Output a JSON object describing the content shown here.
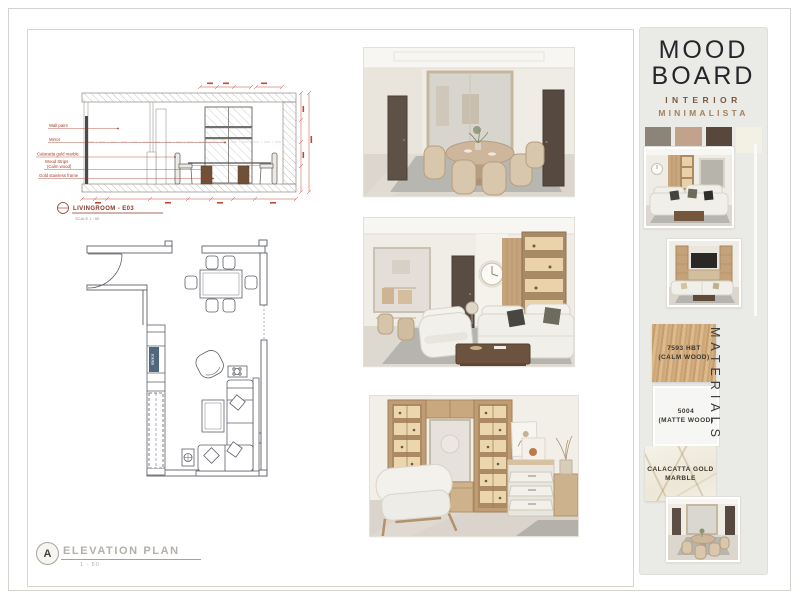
{
  "sheet": {
    "elevation": {
      "callouts": [
        "Wall paint",
        "Mirror",
        "Calacatta gold marble",
        "Wood Strips",
        "(Calm wood)",
        "Gold stainless frame"
      ],
      "title": "LIVINGROOM - E03",
      "scale": "SCALE 1 : 50"
    },
    "floor_plan": {
      "mirror_tag": "mirror"
    },
    "title_block": {
      "marker": "A",
      "label": "ELEVATION PLAN",
      "scale": "1 : 50"
    }
  },
  "moodboard": {
    "title_line_1": "MOOD",
    "title_line_2": "BOARD",
    "subtitle_line_1": "INTERIOR",
    "subtitle_line_2": "MINIMALISTA",
    "palette": [
      {
        "name": "warm-grey",
        "hex": "#8C8478"
      },
      {
        "name": "tan",
        "hex": "#C2A28B"
      },
      {
        "name": "dark-brown",
        "hex": "#58483B"
      },
      {
        "name": "ivory",
        "hex": "#F3F0E4"
      }
    ],
    "materials_heading": "MATERIALS",
    "materials": [
      {
        "code": "7593 HBT",
        "label": "(CALM WOOD)"
      },
      {
        "code": "5004",
        "label": "(MATTE WOOD)"
      },
      {
        "code": "CALACATTA GOLD",
        "label": "MARBLE"
      }
    ]
  }
}
